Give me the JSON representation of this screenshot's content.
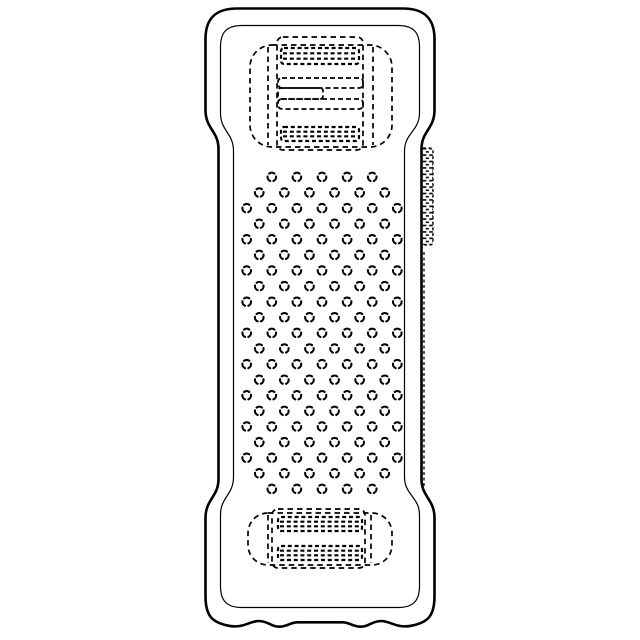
{
  "meta": {
    "background": "#ffffff",
    "line_color": "#000000",
    "canvas_width": 640,
    "canvas_height": 640
  },
  "body": {
    "outer_stroke": 2.6,
    "inner_stroke": 1.2,
    "outer_path": "M 237 8.5 H 403 C 424 8.5 434.5 18 434.5 39 V 110 C 434.5 129 421.5 131 421.5 149 V 479 C 421.5 497 434.5 499 434.5 518 V 596 C 434.5 616 428 622.5 411 625.8 C 396 628.5 390 620.8 381 621 C 371 621.2 369 627.4 359 626.6 C 352 626 350 622.6 343 622.3 H 297 C 290 622.6 288 626 281 626.6 C 271 627.4 269 621.2 259 621 C 250 620.8 244 628.5 229 625.8 C 212 622.5 205.5 616 205.5 596 V 518 C 205.5 499 218.5 497 218.5 479 V 149 C 218.5 131 205.5 129 205.5 110 V 39 C 205.5 18 216 8.5 237 8.5 Z",
    "inner_path": "M 242 25.5 H 398 C 413 25.5 419.5 32 419.5 47 V 113 C 419.5 131 404.5 133 404.5 151 V 477 C 404.5 495 419.5 497 419.5 515 V 586 C 419.5 601 413 607.5 398 607.5 H 242 C 227 607.5 220.5 601 220.5 586 V 515 C 220.5 497 233.5 495 233.5 477 V 151 C 233.5 133 220.5 131 220.5 113 V 47 C 220.5 32 227 25.5 242 25.5 Z"
  },
  "top_unit": {
    "stroke": 1.7,
    "dash": "5.5 4",
    "outer_rect": [
      250,
      45,
      142,
      102,
      22
    ],
    "cap_lines": [
      [
        268,
        47,
        268,
        145
      ],
      [
        373,
        47,
        373,
        145
      ]
    ],
    "inner_rect": [
      277,
      37,
      86,
      113,
      6
    ],
    "bands": [
      {
        "rect": [
          281,
          48,
          78,
          16
        ],
        "lines": 2
      },
      {
        "rect": [
          281,
          127,
          78,
          14
        ],
        "lines": 2
      }
    ],
    "slots": [
      [
        278,
        78,
        85,
        10,
        4
      ],
      [
        278,
        88,
        45,
        11,
        3
      ],
      [
        278,
        99,
        85,
        10,
        4
      ]
    ]
  },
  "bottom_unit": {
    "stroke": 1.7,
    "dash": "5.5 4",
    "outer_rect": [
      248,
      513,
      144,
      52,
      20
    ],
    "cap_lines": [
      [
        268,
        515,
        268,
        563
      ],
      [
        371,
        515,
        371,
        563
      ]
    ],
    "inner_rect": [
      272,
      509,
      93,
      59,
      6
    ],
    "bands": [
      {
        "rect": [
          278,
          517,
          84,
          14
        ],
        "lines": 2
      },
      {
        "rect": [
          278,
          546,
          84,
          14
        ],
        "lines": 2
      }
    ],
    "slots": []
  },
  "side_clip": {
    "stroke": 1.3,
    "dash": "3 2.5",
    "tab_rect": [
      420,
      148,
      13,
      97
    ],
    "hidden_edge": [
      424,
      252,
      424,
      488
    ]
  },
  "grip_texture": {
    "center_x": 322,
    "top_y": 177,
    "row_spacing": 15.6,
    "col_spacing": 25.1,
    "row_counts": [
      5,
      6,
      7,
      6,
      7,
      6,
      7,
      6,
      7,
      6,
      7,
      6,
      7,
      6,
      7,
      6,
      7,
      6,
      7,
      6,
      5
    ],
    "dot_radius": 4.3,
    "dot_stroke": 2.1,
    "arc_span_deg": 76,
    "arc_centers_deg": [
      270,
      30,
      150
    ]
  }
}
